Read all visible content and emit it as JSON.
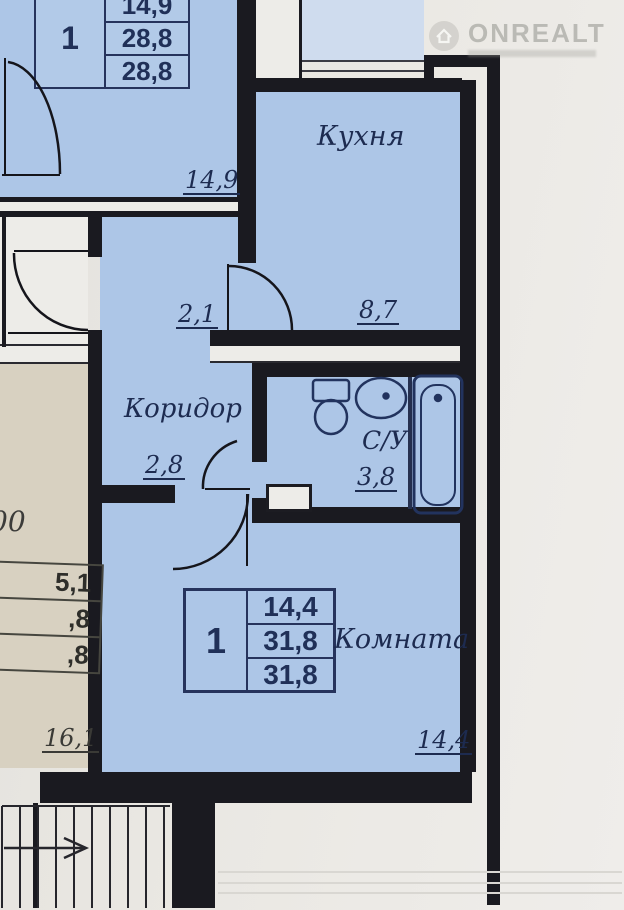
{
  "watermark": {
    "brand": "ONREALT",
    "icon": "house-icon"
  },
  "colors": {
    "paper": "#e9e7e2",
    "room_blue": "#adc6e7",
    "balcony_blue": "#cfdcee",
    "beige": "#d8d1c1",
    "wall": "#1a1a20",
    "ink_navy": "#1d2b50"
  },
  "unit_top_left": {
    "spec_table": {
      "unit_number": "1",
      "rows": [
        "14,9",
        "28,8",
        "28,8"
      ]
    },
    "room_dim": "14,9"
  },
  "main_unit": {
    "kitchen": {
      "label": "Кухня",
      "dim": "8,7"
    },
    "corridor": {
      "label": "Коридор",
      "dim_upper": "2,1",
      "dim_lower": "2,8"
    },
    "bathroom": {
      "label": "С/У",
      "dim": "3,8"
    },
    "room": {
      "label": "Комната",
      "dim": "14,4",
      "spec_table": {
        "unit_number": "1",
        "rows": [
          "14,4",
          "31,8",
          "31,8"
        ]
      }
    }
  },
  "unit_left": {
    "partial_text": "00",
    "spec_table_rows": [
      "5,1",
      ",8",
      ",8"
    ],
    "room_dim": "16,1"
  }
}
